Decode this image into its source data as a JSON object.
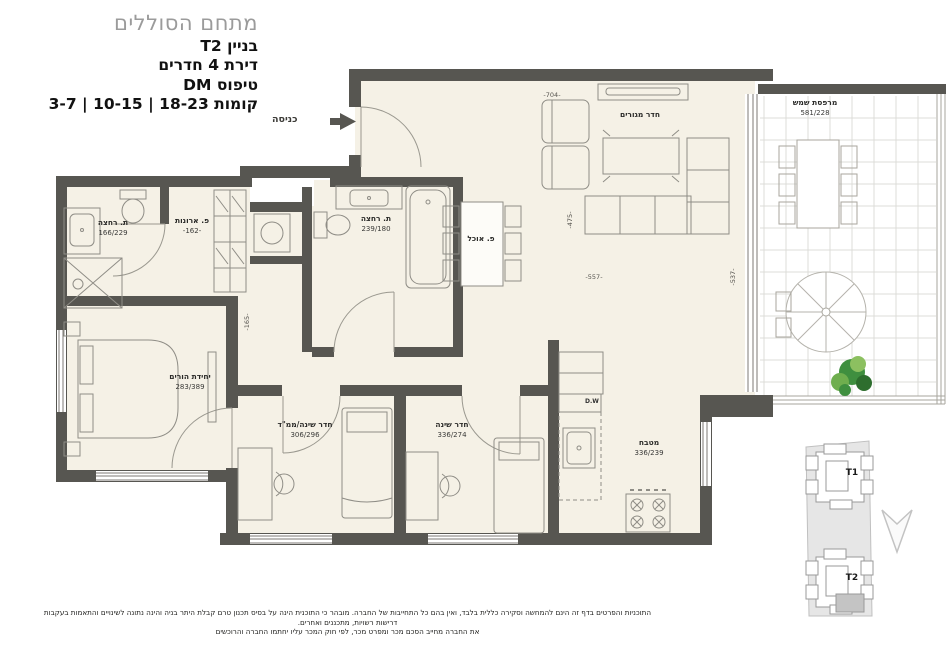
{
  "title": {
    "project": "מתחם הסוללים",
    "building": "בניין T2",
    "apartment": "דירת 4 חדרים",
    "type": "טיפוס DM",
    "floors": "קומות 18-23 | 10-15 | 3-7"
  },
  "entrance_label": "כניסה",
  "rooms": {
    "living": {
      "name": "חדר מגורים"
    },
    "dining": {
      "name": "פ. אוכל"
    },
    "terrace": {
      "name": "מרפסת שמש",
      "dims": "581/228"
    },
    "bath_main": {
      "name": "ת. רחצה",
      "dims": "239/180"
    },
    "bath_parents": {
      "name": "ת. רחצה",
      "dims": "166/229"
    },
    "closets": {
      "name": "פ. ארונות",
      "dims": "-162-"
    },
    "master": {
      "name": "יחידת הורים",
      "dims": "283/389"
    },
    "bedroom_mamad": {
      "name": "חדר שינה/ממ\"ד",
      "dims": "306/296"
    },
    "bedroom": {
      "name": "חדר שינה",
      "dims": "336/274"
    },
    "kitchen": {
      "name": "מטבח",
      "dims": "336/239"
    },
    "dishwasher": "D.W"
  },
  "dimensions": {
    "living_top": "-704-",
    "living_left": "-475-",
    "living_bottom": "-557-",
    "living_right": "-537-",
    "corridor": "-165-"
  },
  "keyplan": {
    "tower1": "T1",
    "tower2": "T2"
  },
  "disclaimer": {
    "line1": "התוכניות והפרטים בדף זה הינם להמחשה וסקירה כללית בלבד, ואין בהם כל התחייבות של החברה. מובהר כי התוכנית הינה על בסיס תכנון טרם קבלת היתר בניה והינה נתונה לשינויים והתאמות בעקבות דרישות רשויות, מתכננים ואחרים.",
    "line2": "את החברה מחייב הסכם מכר ומפרט מכר, לפי חוק המכר עליו יחתמו החברה והרוכשים"
  },
  "colors": {
    "wall": "#575651",
    "floor": "#f5f1e6",
    "title_gray": "#9b9b9b",
    "line": "#8f8d86",
    "plant_green": "#3f8f3f",
    "keyplan_site": "#e6e6e6",
    "keyplan_highlight": "#c4c4c4"
  }
}
